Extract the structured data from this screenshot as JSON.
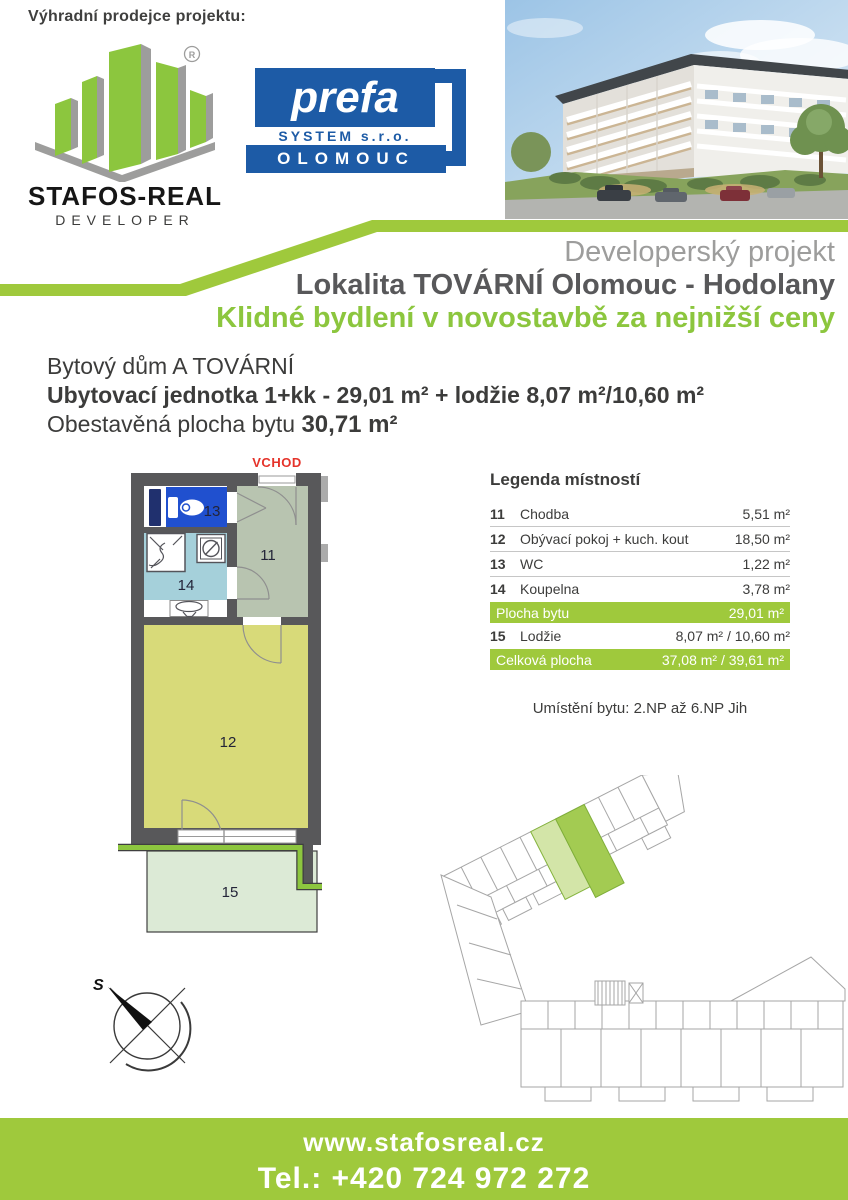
{
  "header": {
    "exclusive_seller_label": "Výhradní prodejce projektu:",
    "stafos_logo": {
      "name": "STAFOS-REAL",
      "subtitle": "DEVELOPER",
      "registered_mark": "R"
    },
    "prefa_logo": {
      "line1": "prefa",
      "line2": "SYSTEM s.r.o.",
      "line3": "OLOMOUC"
    }
  },
  "titles": {
    "project_type": "Developerský projekt",
    "location": "Lokalita TOVÁRNÍ Olomouc - Hodolany",
    "slogan": "Klidné bydlení v novostavbě za nejnižší ceny"
  },
  "unit_info": {
    "building": "Bytový dům A TOVÁRNÍ",
    "unit_line": "Ubytovací jednotka 1+kk - 29,01 m² + lodžie 8,07 m²/10,60 m²",
    "enclosed_area_label": "Obestavěná plocha bytu",
    "enclosed_area_value": "30,71 m²"
  },
  "floor_plan": {
    "entrance_label": "VCHOD",
    "labels": {
      "r11": "11",
      "r12": "12",
      "r13": "13",
      "r14": "14",
      "r15": "15"
    }
  },
  "legend": {
    "title": "Legenda místností",
    "rows": [
      {
        "num": "11",
        "name": "Chodba",
        "area": "5,51 m²"
      },
      {
        "num": "12",
        "name": "Obývací pokoj + kuch. kout",
        "area": "18,50 m²"
      },
      {
        "num": "13",
        "name": "WC",
        "area": "1,22 m²"
      },
      {
        "num": "14",
        "name": "Koupelna",
        "area": "3,78 m²"
      },
      {
        "num": "15",
        "name": "Lodžie",
        "area": "8,07 m² / 10,60 m²"
      }
    ],
    "summary_rows": [
      {
        "label": "Plocha bytu",
        "area": "29,01 m²"
      },
      {
        "label": "Celková plocha",
        "area": "37,08 m² / 39,61 m²"
      }
    ]
  },
  "placement_line": "Umístění bytu: 2.NP až 6.NP Jih",
  "compass": {
    "north_label": "S"
  },
  "footer": {
    "website": "www.stafosreal.cz",
    "phone": "Tel.: +420 724 972 272"
  },
  "colors": {
    "brand_green": "#9fc93c",
    "accent_green": "#8cc63e",
    "prefa_blue": "#1d5ba6",
    "wall_gray": "#58585a",
    "title_gray": "#9d9d9c",
    "entrance_red": "#e5332a",
    "room11": "#b8c4b0",
    "room12": "#d8da79",
    "room13": "#2050cf",
    "room14": "#a5d0da",
    "room15": "#dcead6"
  }
}
